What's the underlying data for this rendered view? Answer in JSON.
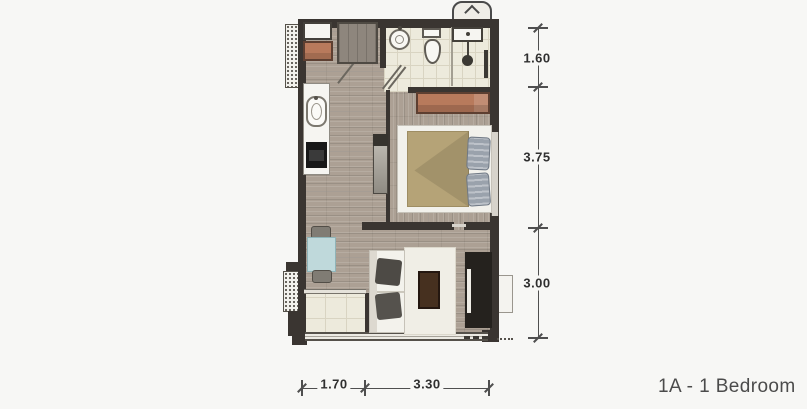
{
  "title": "1A - 1 Bedroom",
  "dimensions": {
    "vertical": [
      {
        "label": "1.60"
      },
      {
        "label": "3.75"
      },
      {
        "label": "3.00"
      }
    ],
    "horizontal": [
      {
        "label": "1.70"
      },
      {
        "label": "3.30"
      }
    ]
  },
  "colors": {
    "bg": "#f7f7f5",
    "wall": "#3a3531",
    "wood": "#aca094",
    "tile": "#edeadc",
    "tile-line": "#d9d4c2",
    "terracotta": "#b87a5c",
    "duvet": "#b5a377",
    "pillow": "#9aa2ac",
    "dining-table": "#bfd9db",
    "rug": "#f0eee6",
    "console": "#25221e",
    "ink": "#2f2f2f"
  }
}
